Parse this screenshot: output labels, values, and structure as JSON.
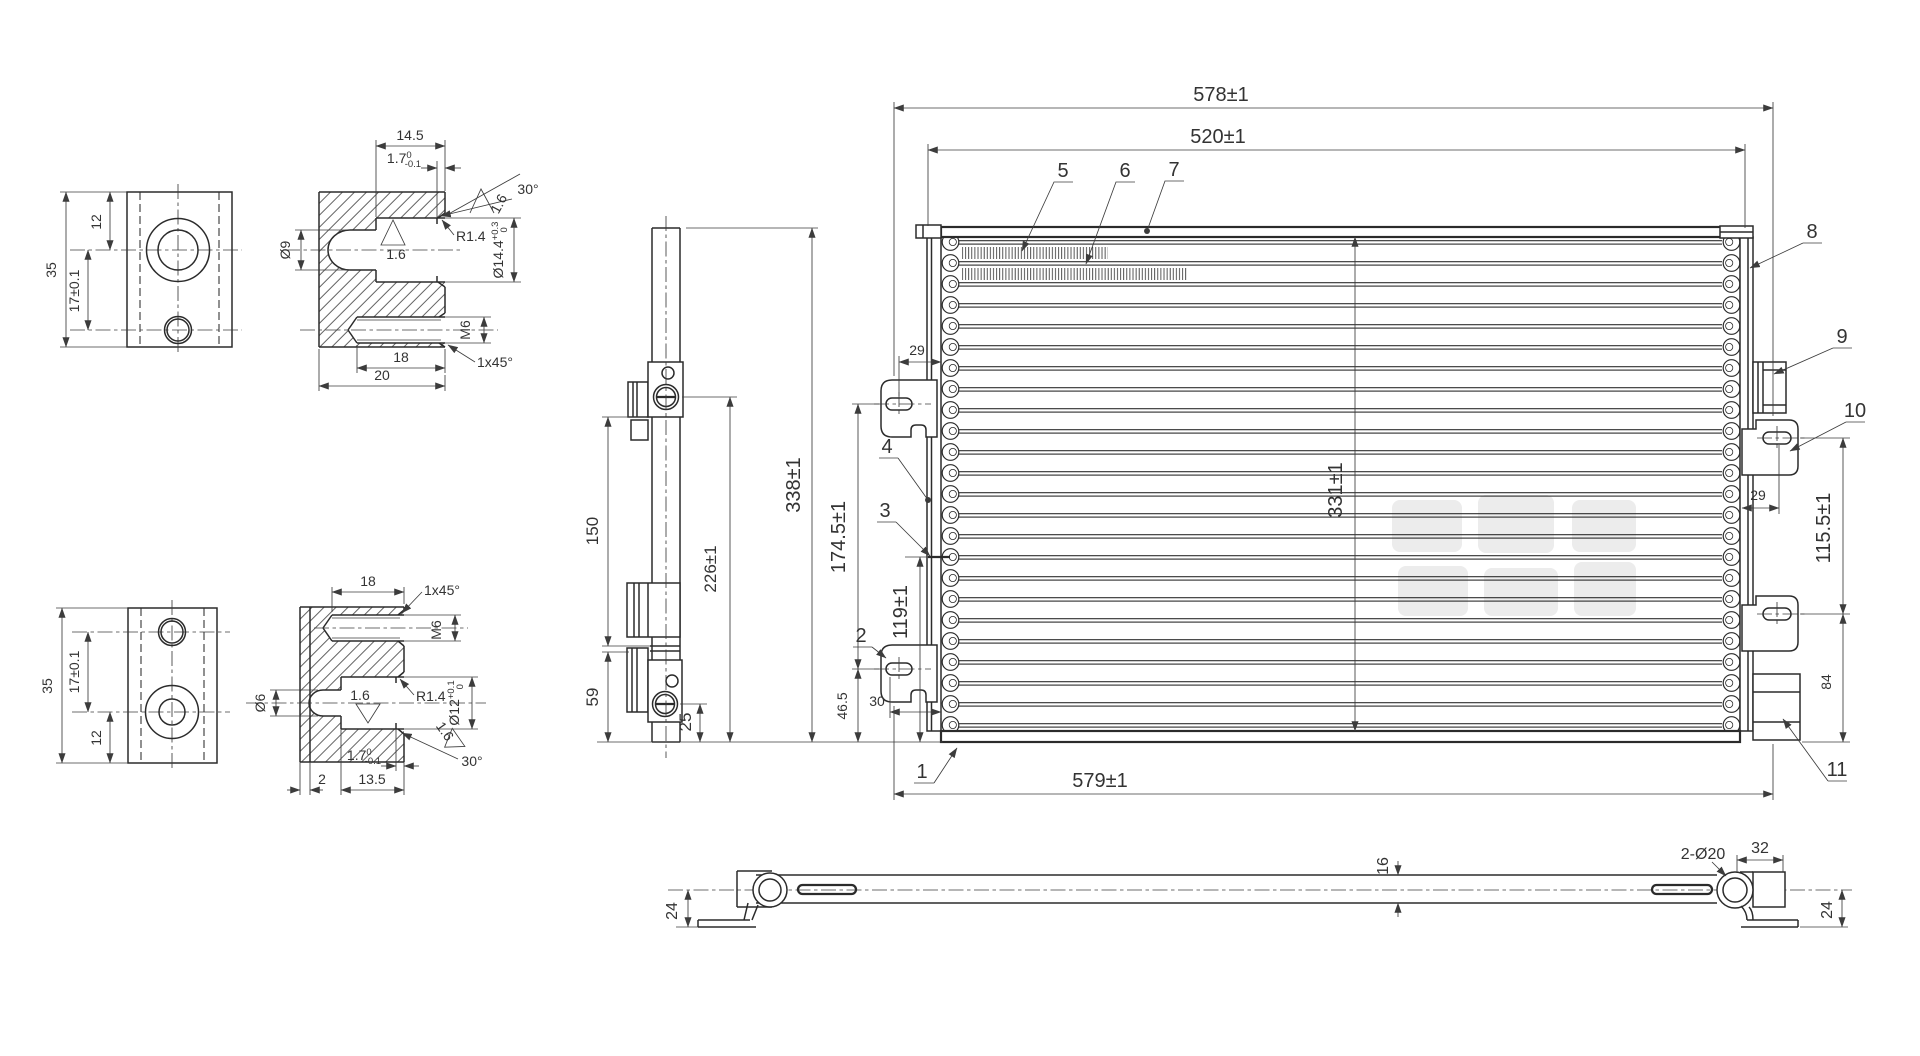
{
  "drawing": {
    "type": "technical-engineering-drawing",
    "subject": "condenser / heat exchanger assembly with fitting details",
    "background": "#ffffff",
    "line_color": "#2b2b2b",
    "text_color": "#333333",
    "watermark_color": "#ececec",
    "pa_f": {
      "height": "35",
      "top_offset": "12",
      "hole_dist": "17±0.1"
    },
    "pa_s": {
      "depth": "14.5",
      "step": "1.7",
      "step_up": "0",
      "step_dn": "-0.1",
      "angle": "30°",
      "fillet": "R1.4",
      "rough_face": "1.6",
      "rough_bore": "1.6",
      "hole_dia": "Ø9",
      "bore_dia": "Ø14.4",
      "bore_up": "+0.3",
      "bore_dn": "0",
      "thread": "M6",
      "chamfer": "1x45°",
      "thread_depth": "18",
      "width": "20"
    },
    "pb_f": {
      "height": "35",
      "hole_dist": "17±0.1",
      "bottom_offset": "12"
    },
    "pb_s": {
      "thread_depth": "18",
      "chamfer": "1x45°",
      "thread": "M6",
      "hole_dia": "Ø6",
      "rough_bore": "1.6",
      "fillet": "R1.4",
      "bore_dia": "Ø12",
      "bore_up": "+0.1",
      "bore_dn": "0",
      "step": "1.7",
      "step_up": "0",
      "step_dn": "-0.1",
      "rough_face": "1.6",
      "angle": "30°",
      "edge": "2",
      "depth": "13.5"
    },
    "sv": {
      "d150": "150",
      "d226": "226±1",
      "d59": "59",
      "d25": "25"
    },
    "mv": {
      "d578": "578±1",
      "d520": "520±1",
      "d579": "579±1",
      "d338": "338±1",
      "d331": "331±1",
      "d1745": "174.5±1",
      "d119": "119±1",
      "d465": "46.5",
      "d30": "30",
      "d29l": "29",
      "d29r": "29",
      "d1155": "115.5±1",
      "d84": "84",
      "callouts": {
        "c1": "1",
        "c2": "2",
        "c3": "3",
        "c4": "4",
        "c5": "5",
        "c6": "6",
        "c7": "7",
        "c8": "8",
        "c9": "9",
        "c10": "10",
        "c11": "11"
      }
    },
    "bv": {
      "d24l": "24",
      "d16": "16",
      "d2d20": "2-Ø20",
      "d32": "32",
      "d24r": "24"
    }
  }
}
